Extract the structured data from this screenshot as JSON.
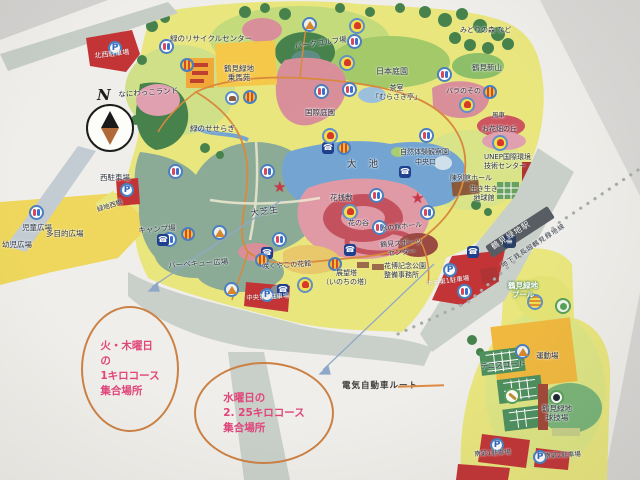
{
  "compass": {
    "label": "N"
  },
  "station": {
    "name": "鶴見緑地駅",
    "line": "地下鉄長堀鶴見緑地線"
  },
  "labels": {
    "nw_parking": "北西駐車場",
    "recycle": "緑のリサイクルセンター",
    "jouba": "鶴見緑地\n乗馬苑",
    "naniwakko": "なにわっこランド",
    "seseragi": "緑のせせらぎ",
    "parkgolf": "パークゴルフ場",
    "nihonteien": "日本庭園",
    "chashitsu": "茶室\n「むらさき亭」",
    "kokusaiteien": "国際庭園",
    "shinzan": "鶴見新山",
    "barazono": "バラのその",
    "fusha": "風車",
    "ohanabatake": "お花畑の丘",
    "midorinomori": "みどりの森 など",
    "nishi_parking": "西駐車場",
    "ryokuchinishibashi": "緑地西橋",
    "jido": "児童広場",
    "tamokuteki": "多目的広場",
    "yoji": "幼児広場",
    "camp": "キャンプ場",
    "bbq": "バーベキュー広場",
    "oshibafu": "大芝生",
    "oike": "大池",
    "hanasajiki": "花桟敷",
    "hananotani": "花の谷",
    "chuoguchi": "中央口",
    "shizentaiken": "自然体験観察園",
    "unep": "UNEP国際環境\n技術センター",
    "chinretsukan": "陳列館ホール",
    "ikiiki": "生き生き\n地球館",
    "mizunoyakata": "水の館ホール",
    "sportscenter": "鶴見スポーツ\nセンター",
    "sakuya": "咲くやこの花館",
    "tenbo": "展望塔\n（いのちの塔）",
    "kahaku": "花博記念公園\n整備事務所",
    "chuo2_parking": "中央第2駐車場",
    "chuo1_parking": "中央第1駐車場",
    "pool": "鶴見緑地\nプール",
    "undojo": "運動場",
    "tennis": "テニスコート",
    "kyugijo": "鶴見緑地\n球技場",
    "minami1_parking": "南第1駐車場",
    "minami2_parking": "南第2駐車場"
  },
  "annotations": {
    "circle1_text": "火・木曜日\nの\n1キロコース\n集合場所",
    "circle2_text": "水曜日の\n2. 25キロコース\n集合場所",
    "ev_legend": "電気自動車ルート",
    "text_color": "#e0457b",
    "circle_color": "#cc8144",
    "ev_route_color": "#d8893c"
  },
  "icons": {
    "phone_glyph": "☎",
    "parking_glyph": "P",
    "train_glyph": "≡",
    "star_glyph": "★"
  },
  "colors": {
    "park_base": "#e9e67e",
    "pond_blue": "#74a5d2",
    "lawn_teal": "#8bab97",
    "parking_red": "#c23436",
    "road_gray": "#c9cfc9"
  }
}
